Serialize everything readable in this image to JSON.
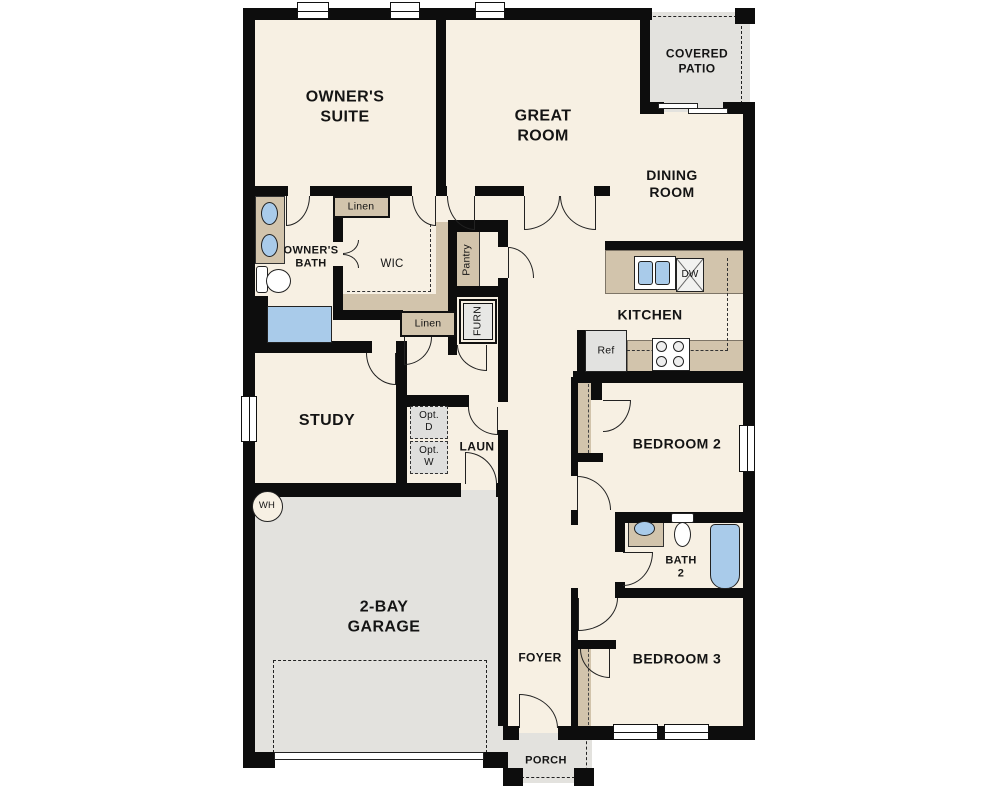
{
  "rooms": {
    "owners_suite": "OWNER'S\nSUITE",
    "great_room": "GREAT\nROOM",
    "covered_patio": "COVERED\nPATIO",
    "dining_room": "DINING\nROOM",
    "owners_bath": "OWNER'S\nBATH",
    "walk_in_closet": "WIC",
    "kitchen": "KITCHEN",
    "study": "STUDY",
    "laundry": "LAUN",
    "garage": "2-BAY\nGARAGE",
    "foyer": "FOYER",
    "bedroom_2": "BEDROOM 2",
    "bath_2": "BATH\n2",
    "bedroom_3": "BEDROOM 3",
    "porch": "PORCH"
  },
  "closets_fixtures": {
    "linen_upper": "Linen",
    "linen_lower": "Linen",
    "pantry": "Pantry",
    "furnace": "FURN",
    "refrigerator": "Ref",
    "dishwasher": "DW",
    "water_heater": "WH",
    "opt_dryer": "Opt.\nD",
    "opt_washer": "Opt.\nW"
  },
  "colors": {
    "wall": "#0d0d0d",
    "floor": "#f7f0e3",
    "outdoor": "#e3e2de",
    "counter": "#d2c4ac",
    "fixture_blue": "#a9cbea",
    "line": "#222222"
  }
}
